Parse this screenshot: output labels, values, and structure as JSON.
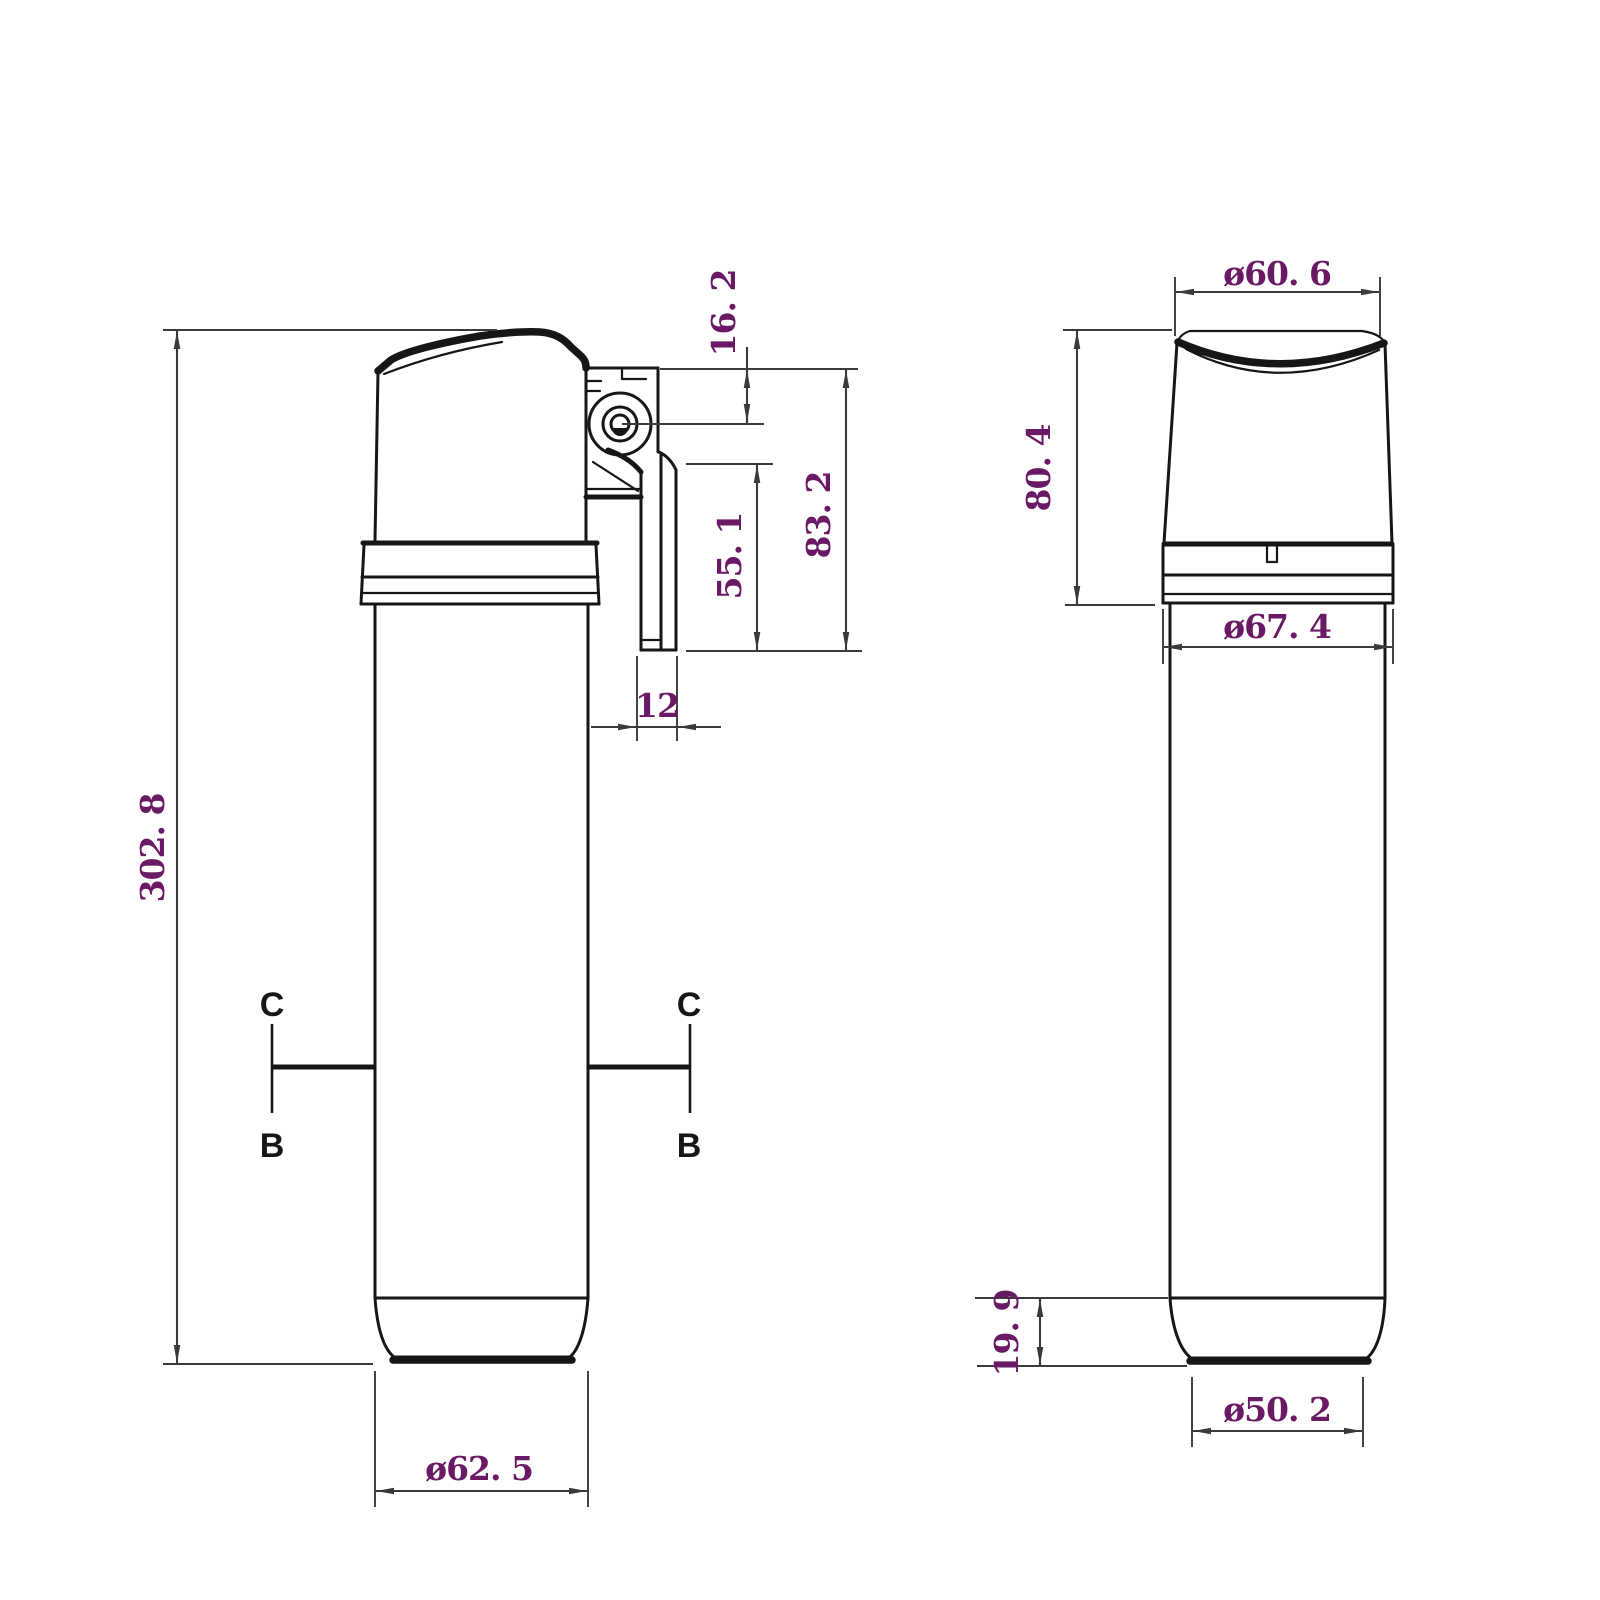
{
  "colors": {
    "background": "#ffffff",
    "outline": "#161616",
    "dimension": "#3a3a3a",
    "dim_text": "#6a1a64",
    "section_text": "#161616"
  },
  "side_view": {
    "dims": {
      "overall_height": "302. 8",
      "top_to_port": "16. 2",
      "top_to_bracket": "83. 2",
      "port_to_bracket": "55. 1",
      "bracket_width": "12",
      "base_dia": "ø62. 5"
    },
    "sections": {
      "left_top": "C",
      "left_bottom": "B",
      "right_top": "C",
      "right_bottom": "B"
    }
  },
  "front_view": {
    "dims": {
      "top_dia": "ø60. 6",
      "head_height": "80. 4",
      "collar_dia": "ø67. 4",
      "foot_height": "19. 9",
      "bottom_dia": "ø50. 2"
    }
  }
}
